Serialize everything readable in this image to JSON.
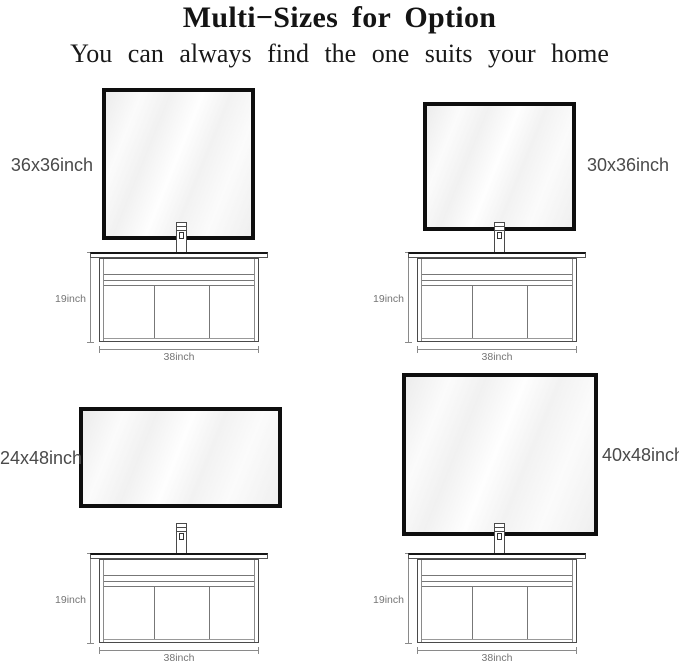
{
  "header": {
    "title": "Multi−Sizes for Option",
    "subtitle": "You can always find the one suits your home"
  },
  "variants": [
    {
      "size_label": "36x36inch",
      "cabinet_height": "19inch",
      "cabinet_width": "38inch"
    },
    {
      "size_label": "30x36inch",
      "cabinet_height": "19inch",
      "cabinet_width": "38inch"
    },
    {
      "size_label": "24x48inch",
      "cabinet_height": "19inch",
      "cabinet_width": "38inch"
    },
    {
      "size_label": "40x48inch",
      "cabinet_height": "19inch",
      "cabinet_width": "38inch"
    }
  ],
  "colors": {
    "mirror_frame": "#0e0e0e",
    "line_art": "#555555",
    "dimension_text": "#757575",
    "size_label_text": "#4a4a4a",
    "background": "#ffffff"
  }
}
